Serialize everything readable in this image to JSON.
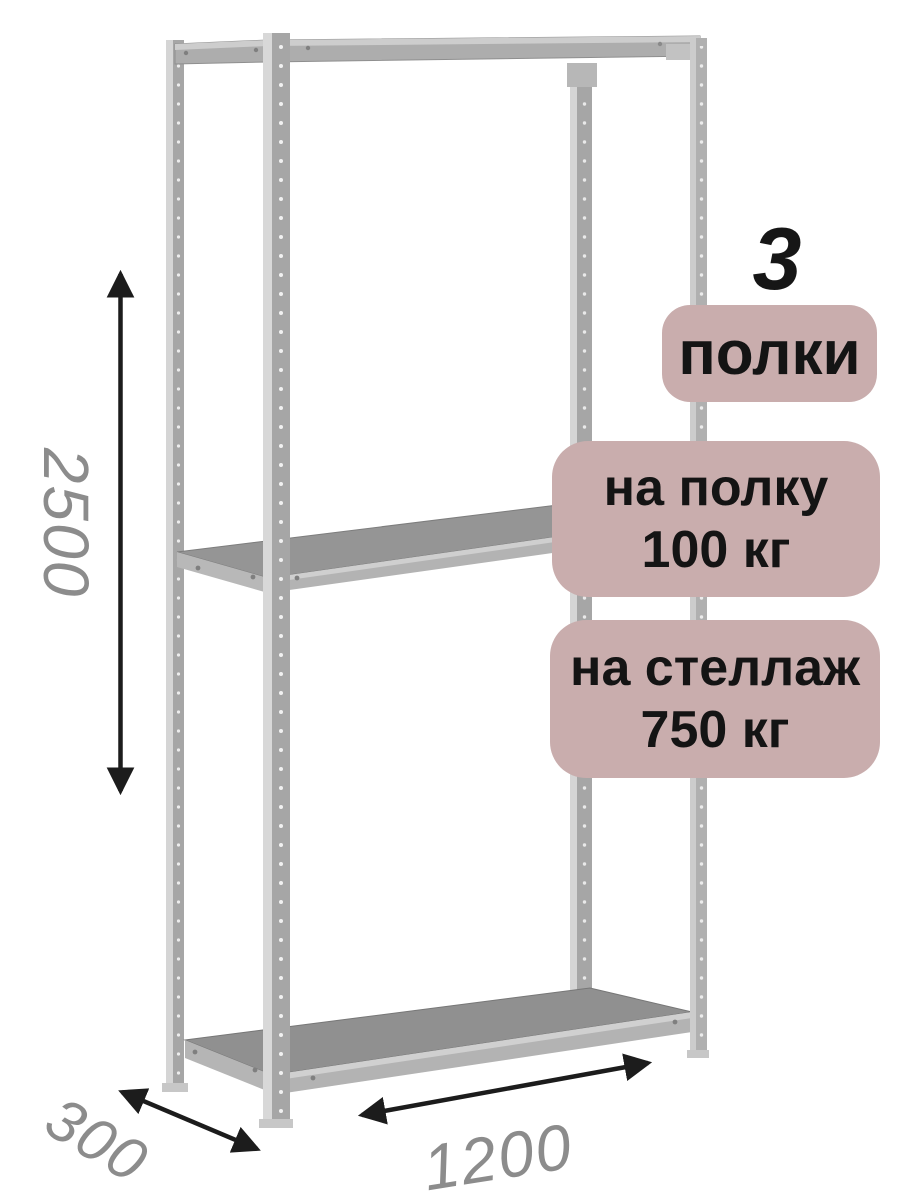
{
  "product": {
    "shelves_count": "3",
    "shelves_label": "полки",
    "shelf_load": {
      "line1": "на полку",
      "line2": "100 кг"
    },
    "rack_load": {
      "line1": "на стеллаж",
      "line2": "750 кг"
    }
  },
  "dimensions": {
    "height": "2500",
    "depth": "300",
    "width": "1200"
  },
  "colors": {
    "badge_bg": "#c9adad",
    "badge_text": "#141414",
    "dim_text": "#8c8c8c",
    "arrow": "#1c1c1c",
    "metal_light": "#d5d5d5",
    "metal_dark": "#a6a6a6",
    "shelf_top": "#959595",
    "shelf_band": "#b3b3b3"
  }
}
